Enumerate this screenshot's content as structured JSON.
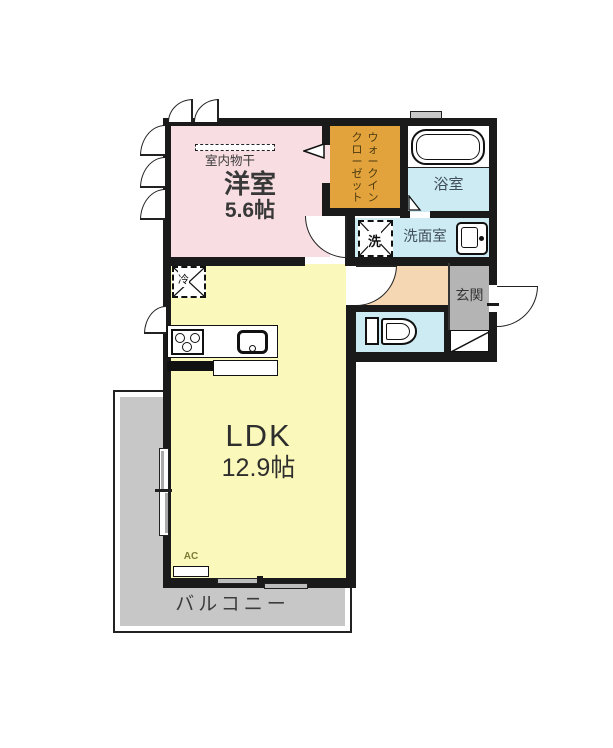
{
  "plan": {
    "title": "1LDK apartment floor plan",
    "rooms": {
      "bedroom": {
        "label": "洋室",
        "size": "5.6帖",
        "note": "室内物干"
      },
      "wic": {
        "line1": "ウォークイン",
        "line2": "クローゼット"
      },
      "bathroom": {
        "label": "浴室"
      },
      "washroom": {
        "label": "洗面室",
        "washer": "洗"
      },
      "entrance": {
        "label": "玄関"
      },
      "ldk": {
        "label": "LDK",
        "size": "12.9帖",
        "fridge": "冷",
        "ac": "AC"
      },
      "balcony": {
        "label": "バルコニー"
      }
    },
    "colors": {
      "wall": "#1a1a1a",
      "bedroom": "#f8dee3",
      "wic": "#e3a33c",
      "water_rooms": "#cdebf3",
      "hallway": "#f6d7b3",
      "entrance": "#b4b4b4",
      "ldk": "#faf8ba",
      "balcony": "#c7c7c7"
    }
  }
}
